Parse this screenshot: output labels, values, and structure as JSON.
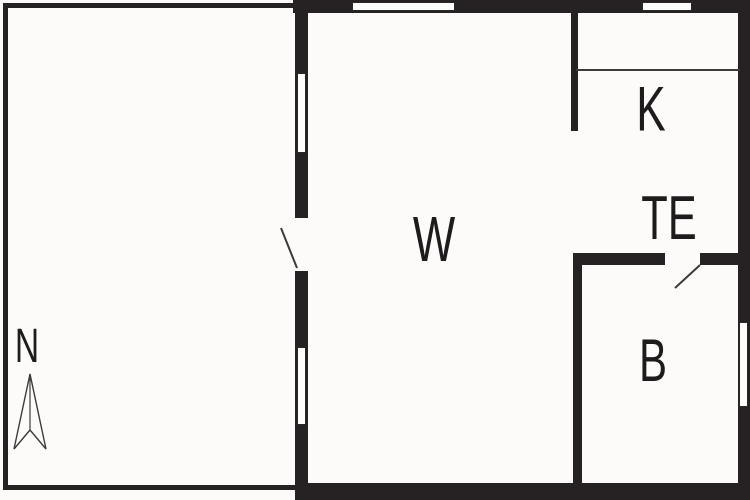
{
  "plan": {
    "title": "apartment-floor-plan",
    "rooms": [
      {
        "id": "living",
        "label": "W"
      },
      {
        "id": "kitchen",
        "label": "K"
      },
      {
        "id": "entrance",
        "label": "TE"
      },
      {
        "id": "bedroom",
        "label": "B"
      },
      {
        "id": "terrace",
        "label": ""
      }
    ],
    "compass": {
      "label": "N",
      "direction": "north"
    },
    "colors": {
      "wall": "#262123",
      "thin_line": "#3d3a3a",
      "background": "#fcfbf9",
      "window_fill": "#fdfdfc",
      "label_text": "#1e1b1c"
    }
  }
}
